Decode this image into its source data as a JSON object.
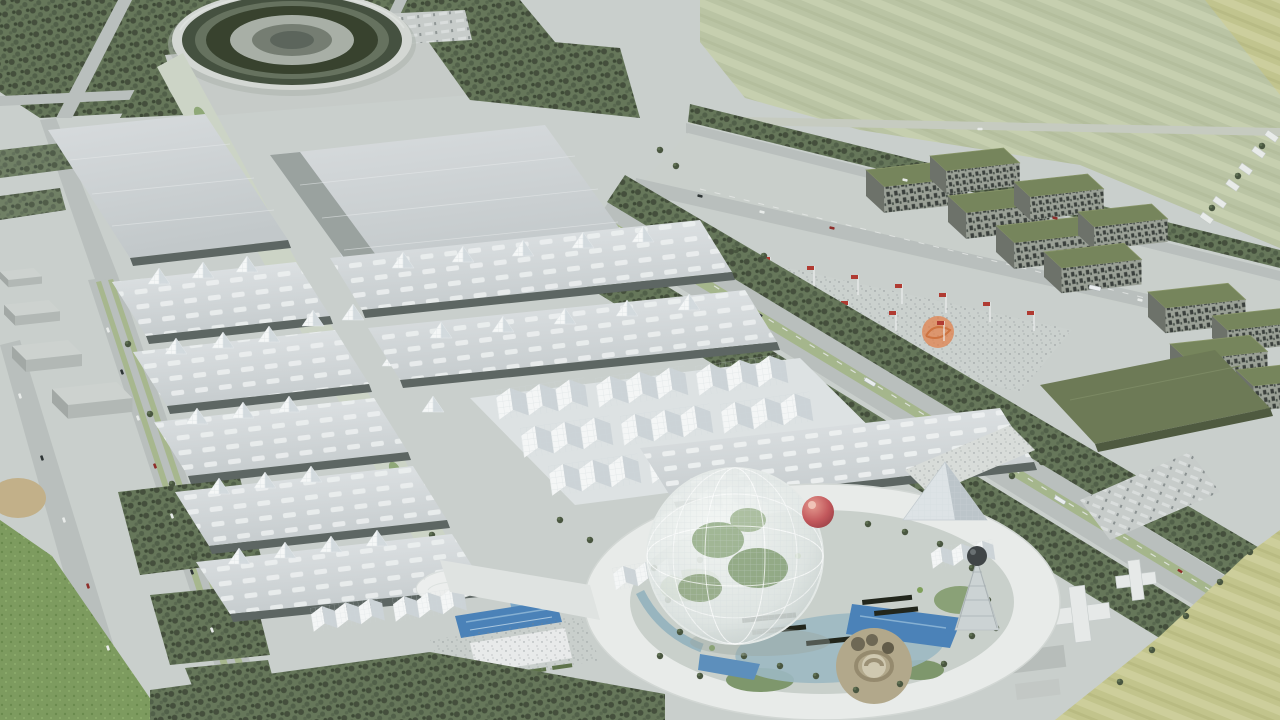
{
  "scene": {
    "kind": "aerial-architectural-rendering",
    "description": "Bird's-eye 3D masterplan render of an expo campus: elliptical stadium, grid of sawtooth exhibition halls, landscaped central spine, circular ring plaza with geodesic sphere and red ball sculpture, flag plaza, green-roof apartment blocks, tree-lined boulevards, highways and farmland."
  },
  "palette": {
    "ground": "#c9cfcc",
    "pavement": "#c9cfcc",
    "pavement_light": "#d2d6d3",
    "road": "#b9bfbd",
    "road_marking": "#e6e9e7",
    "median_green": "#a3b586",
    "grass": "#7d9b5f",
    "field_green": "#bac4a4",
    "field_yellow": "#c2c48c",
    "tree_dark": "#44503c",
    "tree_mid": "#5f7052",
    "hall_roof": "#d6dadd",
    "hall_roof_light": "#e7eaec",
    "hall_dark": "#5d6663",
    "canopy_white": "#f3f5f6",
    "canopy_shadow": "#ccd3d7",
    "stadium_dark": "#3c4837",
    "stadium_rim": "#d3d7d3",
    "apartment_roof": "#76855b",
    "apartment_window": "#3a413c",
    "plaza_white": "#e8ebe9",
    "water_light": "#9cb8c2",
    "water_blue": "#4b82b8",
    "red_ball": "#c2585c",
    "orange_sculpture": "#e2824d",
    "flag_red": "#b03a33",
    "rock_tan": "#b2a88b",
    "solar_dark": "#20261f"
  },
  "landmarks": [
    {
      "id": "stadium",
      "label": "Elliptical stadium with planted terrace bands"
    },
    {
      "id": "big-halls",
      "label": "Two large flat-roof exhibition halls"
    },
    {
      "id": "hall-rows-west",
      "label": "Sawtooth exhibition hall rows, west block"
    },
    {
      "id": "hall-rows-east",
      "label": "Sawtooth exhibition hall rows, east block"
    },
    {
      "id": "green-spine",
      "label": "Landscaped pedestrian spine from stadium to plaza"
    },
    {
      "id": "canopy-field",
      "label": "Folded white lattice canopy field"
    },
    {
      "id": "ring-plaza",
      "label": "Elliptical ring plaza"
    },
    {
      "id": "geodesic-dome",
      "label": "Geodesic greenhouse sphere with trees inside"
    },
    {
      "id": "red-sphere",
      "label": "Floating red sphere sculpture"
    },
    {
      "id": "glass-pyramid",
      "label": "Glass pyramid pavilion"
    },
    {
      "id": "lattice-tower",
      "label": "Lattice tower with dark sphere cap"
    },
    {
      "id": "flag-plaza",
      "label": "Flag plaza with red flags and crowds"
    },
    {
      "id": "orange-pavilion",
      "label": "Orange wireframe sculpture"
    },
    {
      "id": "apartments",
      "label": "Green-roof residential blocks"
    },
    {
      "id": "farm-field",
      "label": "Striped farmland, top right"
    },
    {
      "id": "tree-boulevard",
      "label": "Tree-lined boulevard crossing the site"
    },
    {
      "id": "west-highway",
      "label": "Western highway with green lane markings"
    },
    {
      "id": "entrance-buildings",
      "label": "South entrance pavilions"
    },
    {
      "id": "water-canal",
      "label": "Bright blue entrance canal"
    },
    {
      "id": "rock-garden",
      "label": "Spiral rock garden inside the plaza"
    }
  ]
}
